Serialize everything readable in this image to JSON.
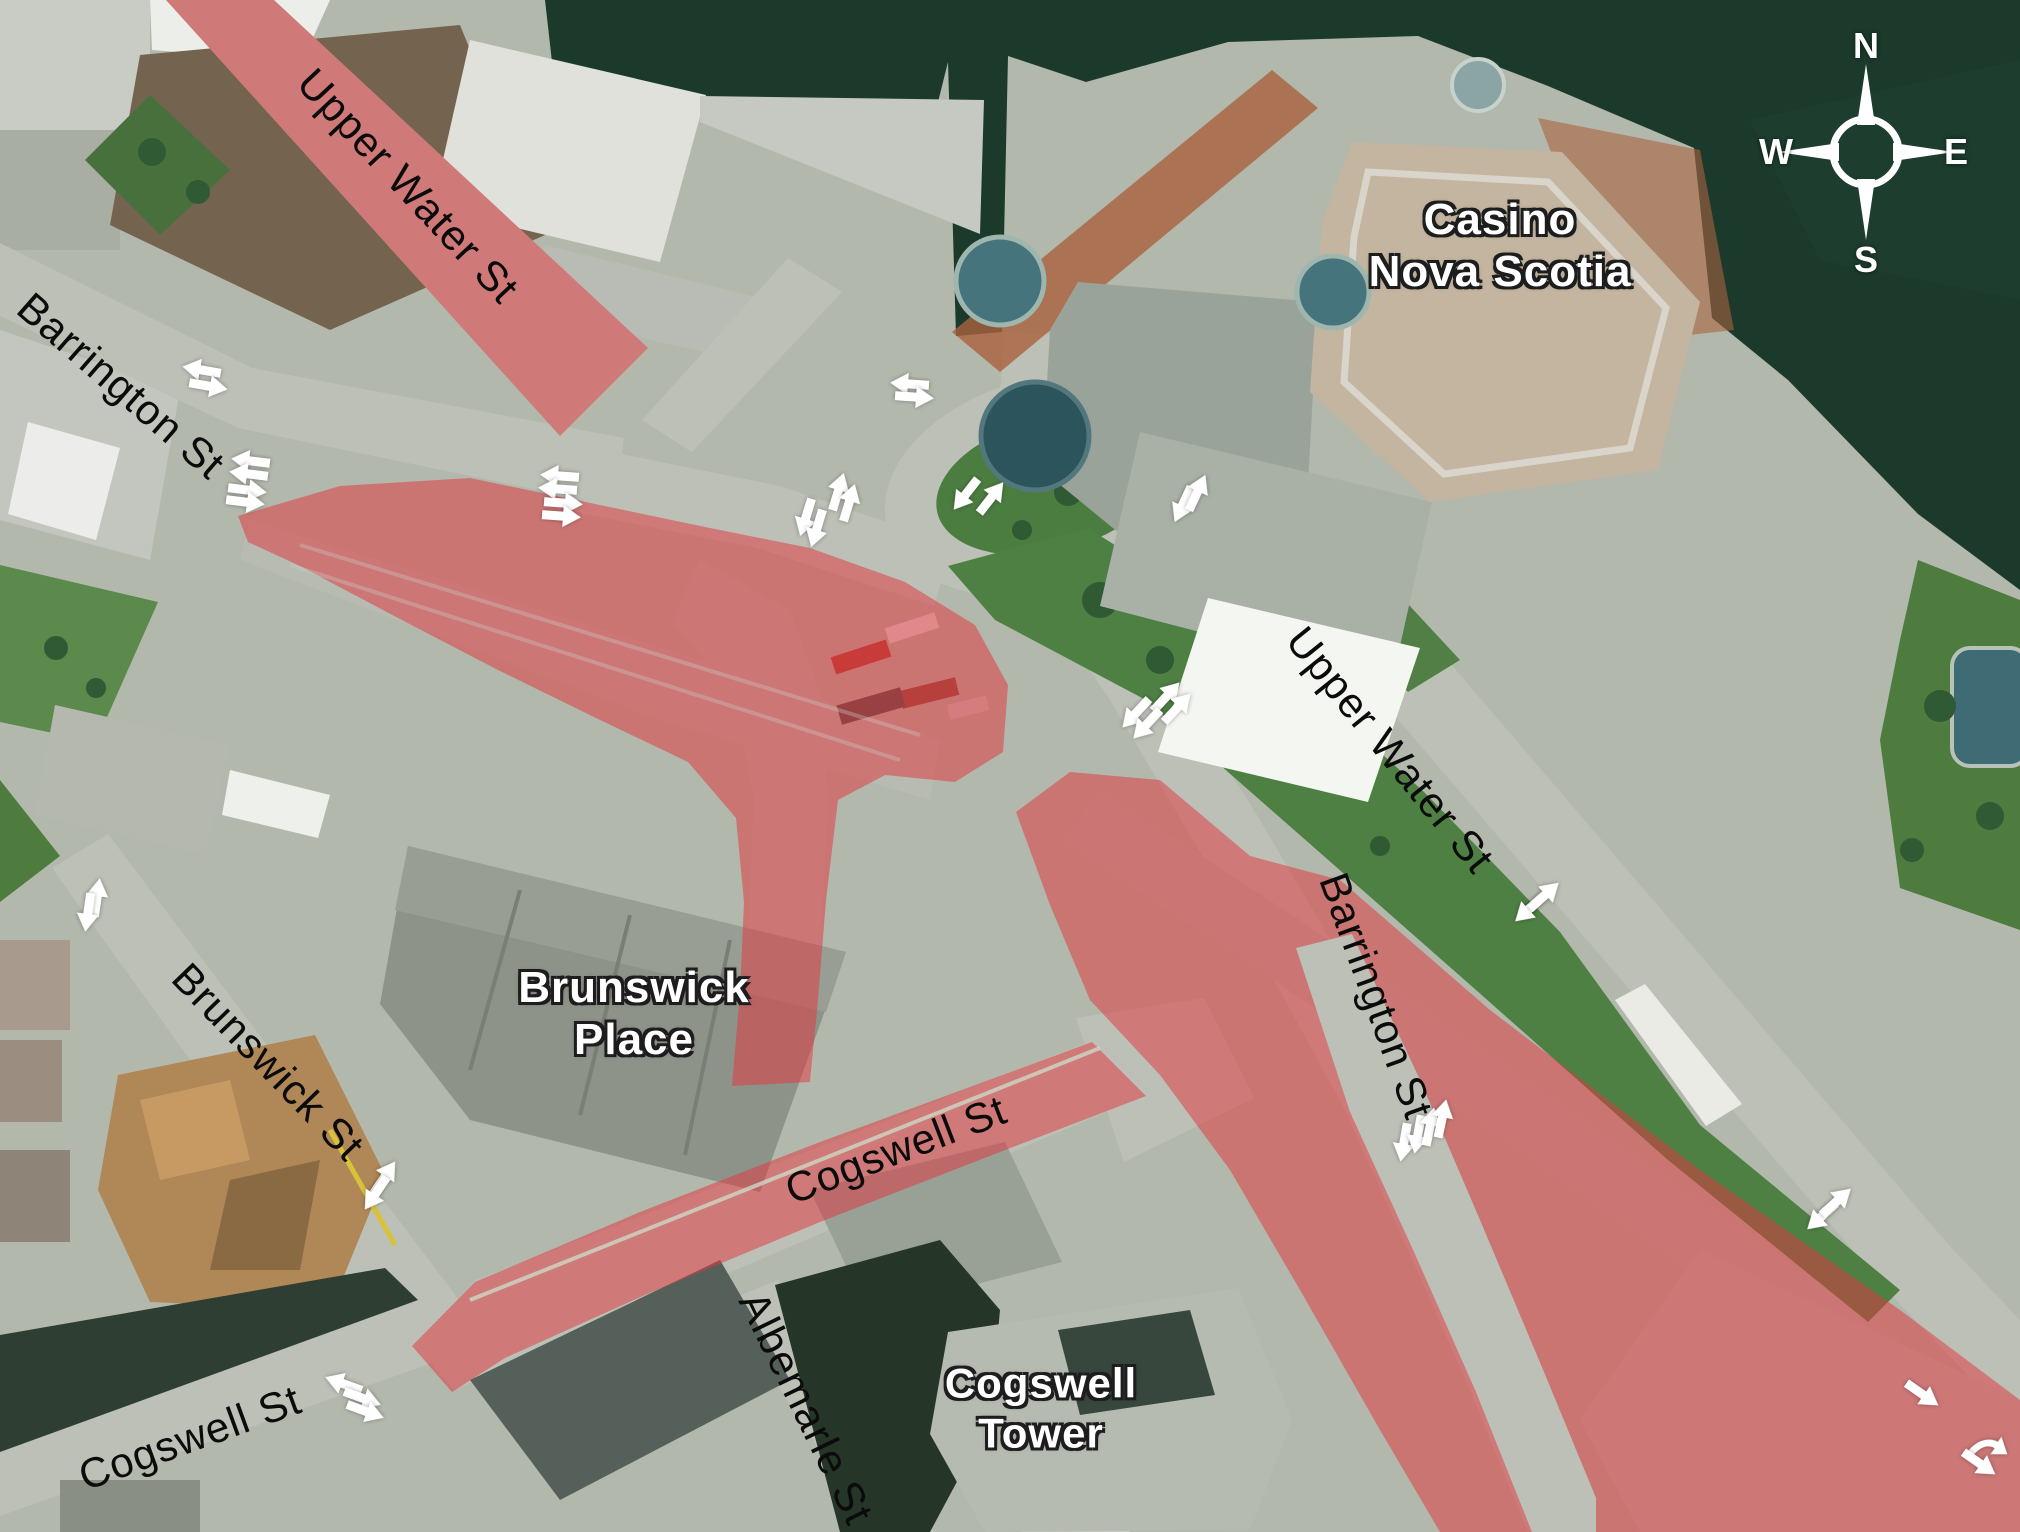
{
  "map_type": "aerial-road-closure-map",
  "compass": {
    "north": "N",
    "east": "E",
    "south": "S",
    "west": "W"
  },
  "street_labels": [
    {
      "id": "upper-water-st-nw",
      "text": "Upper Water St"
    },
    {
      "id": "barrington-st-nw",
      "text": "Barrington St"
    },
    {
      "id": "upper-water-st-se",
      "text": "Upper Water St"
    },
    {
      "id": "barrington-st-s",
      "text": "Barrington St"
    },
    {
      "id": "brunswick-st",
      "text": "Brunswick St"
    },
    {
      "id": "cogswell-st-mid",
      "text": "Cogswell St"
    },
    {
      "id": "cogswell-st-sw",
      "text": "Cogswell St"
    },
    {
      "id": "albemarle-st",
      "text": "Albemarle St"
    }
  ],
  "place_labels": [
    {
      "id": "casino-nova-scotia",
      "line1": "Casino",
      "line2": "Nova Scotia"
    },
    {
      "id": "brunswick-place",
      "line1": "Brunswick",
      "line2": "Place"
    },
    {
      "id": "cogswell-tower",
      "line1": "Cogswell",
      "line2": "Tower"
    }
  ],
  "colors": {
    "closure_overlay": "#e03840",
    "water": "#1b3a2b",
    "road": "#bcc0b6",
    "lawn": "#4e8044",
    "arrow": "#ffffff"
  },
  "arrows": [
    {
      "x": 202,
      "y": 370,
      "a": 190
    },
    {
      "x": 208,
      "y": 386,
      "a": 10
    },
    {
      "x": 251,
      "y": 461,
      "a": 187
    },
    {
      "x": 249,
      "y": 474,
      "a": 187
    },
    {
      "x": 247,
      "y": 490,
      "a": 7
    },
    {
      "x": 245,
      "y": 502,
      "a": 7
    },
    {
      "x": 560,
      "y": 476,
      "a": 184
    },
    {
      "x": 558,
      "y": 489,
      "a": 184
    },
    {
      "x": 563,
      "y": 503,
      "a": 4
    },
    {
      "x": 561,
      "y": 516,
      "a": 4
    },
    {
      "x": 838,
      "y": 492,
      "a": -73
    },
    {
      "x": 849,
      "y": 503,
      "a": -73
    },
    {
      "x": 806,
      "y": 517,
      "a": 107
    },
    {
      "x": 817,
      "y": 528,
      "a": 107
    },
    {
      "x": 966,
      "y": 494,
      "a": 128
    },
    {
      "x": 991,
      "y": 498,
      "a": -52
    },
    {
      "x": 910,
      "y": 384,
      "a": 184
    },
    {
      "x": 914,
      "y": 397,
      "a": 4
    },
    {
      "x": 1183,
      "y": 504,
      "a": 115
    },
    {
      "x": 1197,
      "y": 493,
      "a": -65
    },
    {
      "x": 1166,
      "y": 697,
      "a": -47
    },
    {
      "x": 1177,
      "y": 708,
      "a": -47
    },
    {
      "x": 1136,
      "y": 713,
      "a": 133
    },
    {
      "x": 1147,
      "y": 724,
      "a": 133
    },
    {
      "x": 97,
      "y": 898,
      "a": -82
    },
    {
      "x": 88,
      "y": 912,
      "a": 98
    },
    {
      "x": 384,
      "y": 1178,
      "a": -56
    },
    {
      "x": 376,
      "y": 1193,
      "a": 124
    },
    {
      "x": 344,
      "y": 1384,
      "a": 200
    },
    {
      "x": 362,
      "y": 1398,
      "a": 20
    },
    {
      "x": 365,
      "y": 1411,
      "a": 20
    },
    {
      "x": 1404,
      "y": 1142,
      "a": 100
    },
    {
      "x": 1418,
      "y": 1134,
      "a": 100
    },
    {
      "x": 1430,
      "y": 1127,
      "a": -78
    },
    {
      "x": 1442,
      "y": 1119,
      "a": -78
    },
    {
      "x": 1530,
      "y": 908,
      "a": 138
    },
    {
      "x": 1544,
      "y": 896,
      "a": -42
    },
    {
      "x": 1822,
      "y": 1216,
      "a": 138
    },
    {
      "x": 1836,
      "y": 1202,
      "a": -42
    },
    {
      "x": 1922,
      "y": 1394,
      "a": 35
    },
    {
      "x": 1988,
      "y": 1446,
      "a": 18,
      "curved": true
    },
    {
      "x": 1979,
      "y": 1463,
      "a": 35
    }
  ]
}
